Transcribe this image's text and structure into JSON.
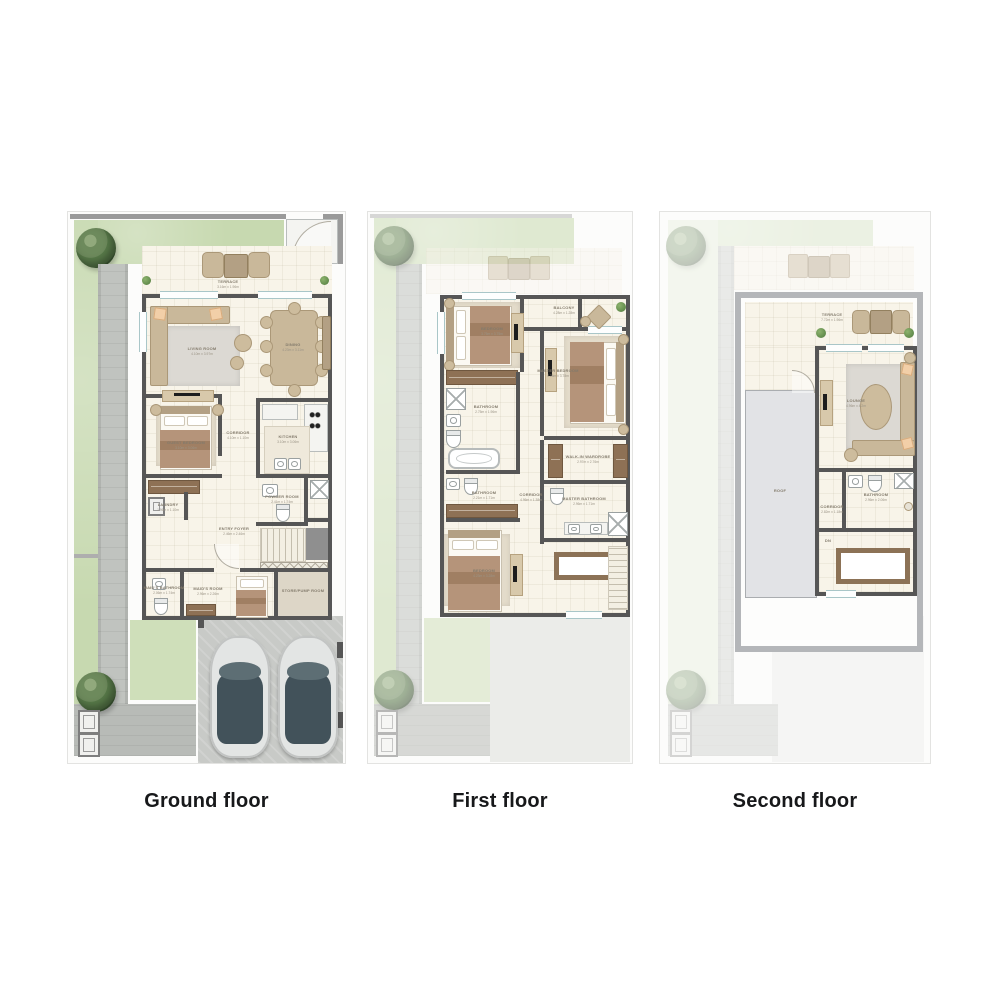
{
  "palette": {
    "wall": "#565656",
    "outer_wall_light": "#b4b6b9",
    "floor_cream": "#f8f4e9",
    "garden_green": "#c7d9b0",
    "paving_gray": "#b8bbb7",
    "driveway_gray": "#c8cac7",
    "furniture_tan": "#c9b89a",
    "wood_brown": "#8e7155",
    "roof_gray": "#e2e3e6",
    "title_color": "#17181a"
  },
  "floors": [
    {
      "id": "ground",
      "label": "Ground floor",
      "rooms": {
        "terrace": {
          "name": "TERRACE",
          "dims": "3.16m x 1.96m"
        },
        "living": {
          "name": "LIVING ROOM",
          "dims": "4.10m x 3.97m"
        },
        "dining": {
          "name": "DINING",
          "dims": "4.23m x 3.11m"
        },
        "guest": {
          "name": "GUEST BEDROOM",
          "dims": "3.10m x 3.06m"
        },
        "corridor": {
          "name": "CORRIDOR",
          "dims": "4.10m x 1.10m"
        },
        "kitchen": {
          "name": "KITCHEN",
          "dims": "3.10m x 3.06m"
        },
        "laundry": {
          "name": "LAUNDRY",
          "dims": "1.96m x 1.10m"
        },
        "entry": {
          "name": "ENTRY FOYER",
          "dims": "2.46m x 2.46m"
        },
        "powder": {
          "name": "POWDER ROOM",
          "dims": "2.41m x 1.74m"
        },
        "maids_room": {
          "name": "MAID'S ROOM",
          "dims": "2.96m x 2.26m"
        },
        "maids_bath": {
          "name": "MAID'S BATHROOM",
          "dims": "2.06m x 1.74m"
        },
        "store": {
          "name": "STORE/PUMP ROOM",
          "dims": ""
        }
      }
    },
    {
      "id": "first",
      "label": "First floor",
      "rooms": {
        "bedroom1": {
          "name": "BEDROOM",
          "dims": "3.75m x 3.75m"
        },
        "balcony": {
          "name": "BALCONY",
          "dims": "4.28m x 1.28m"
        },
        "master": {
          "name": "MASTER BEDROOM",
          "dims": "4.28m x 3.78m"
        },
        "bathroom1": {
          "name": "BATHROOM",
          "dims": "2.75m x 1.96m"
        },
        "walkin": {
          "name": "WALK-IN WARDROBE",
          "dims": "2.97m x 2.76m"
        },
        "corridor": {
          "name": "CORRIDOR",
          "dims": "4.96m x 1.38m"
        },
        "bathroom2": {
          "name": "BATHROOM",
          "dims": "2.21m x 1.71m"
        },
        "master_bath": {
          "name": "MASTER BATHROOM",
          "dims": "2.96m x 1.71m"
        },
        "bedroom2": {
          "name": "BEDROOM",
          "dims": "4.23m x 3.28m"
        }
      }
    },
    {
      "id": "second",
      "label": "Second floor",
      "rooms": {
        "terrace": {
          "name": "TERRACE",
          "dims": "7.72m x 1.96m"
        },
        "lounge": {
          "name": "LOUNGE",
          "dims": "4.96m x 4.2m"
        },
        "roof": {
          "name": "ROOF",
          "dims": ""
        },
        "corridor": {
          "name": "CORRIDOR",
          "dims": "2.82m x 1.18m"
        },
        "bathroom": {
          "name": "BATHROOM",
          "dims": "2.96m x 2.06m"
        },
        "stairs_dn": {
          "name": "DN",
          "dims": ""
        }
      }
    }
  ]
}
